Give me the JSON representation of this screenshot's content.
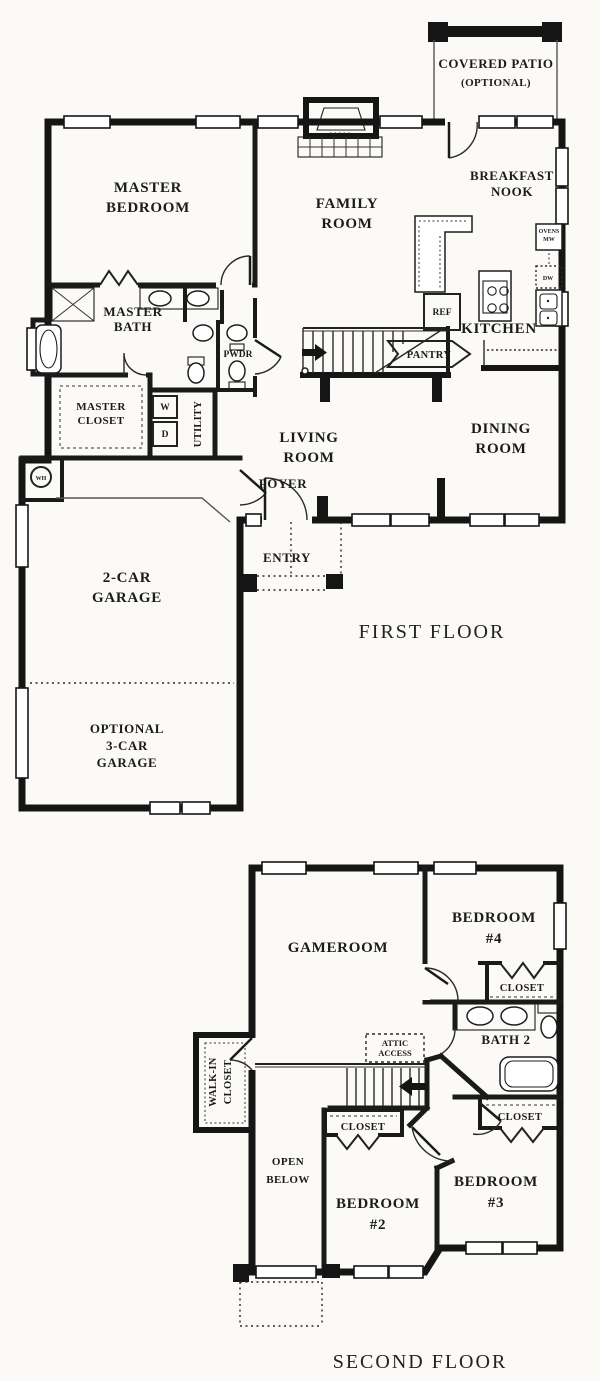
{
  "document": {
    "type": "two-story residential floor plan"
  },
  "colors": {
    "wall": "#151515",
    "paper": "#fbfaf6"
  },
  "ff": {
    "caption": "FIRST FLOOR",
    "covered_patio": [
      "COVERED PATIO",
      "(OPTIONAL)"
    ],
    "breakfast_nook": [
      "BREAKFAST",
      "NOOK"
    ],
    "master_bedroom": [
      "MASTER",
      "BEDROOM"
    ],
    "family_room": [
      "FAMILY",
      "ROOM"
    ],
    "kitchen": "KITCHEN",
    "ref": "REF",
    "ovens": "OVENS",
    "mw": "MW",
    "dw": "DW",
    "master_bath": [
      "MASTER",
      "BATH"
    ],
    "pwdr": "PWDR",
    "master_closet": [
      "MASTER",
      "CLOSET"
    ],
    "washer": "W",
    "dryer": "D",
    "utility": "UTILITY",
    "wh": "WH",
    "pantry": "PANTRY",
    "living_room": [
      "LIVING",
      "ROOM"
    ],
    "dining_room": [
      "DINING",
      "ROOM"
    ],
    "foyer": "FOYER",
    "entry": "ENTRY",
    "garage2": [
      "2-CAR",
      "GARAGE"
    ],
    "garage3": [
      "OPTIONAL",
      "3-CAR",
      "GARAGE"
    ]
  },
  "sf": {
    "caption": "SECOND FLOOR",
    "gameroom": "GAMEROOM",
    "bedroom4": [
      "BEDROOM",
      "#4"
    ],
    "closet_b4": "CLOSET",
    "bath2": "BATH 2",
    "closet_b3": "CLOSET",
    "attic": [
      "ATTIC",
      "ACCESS"
    ],
    "walkin": [
      "WALK-IN",
      "CLOSET"
    ],
    "open_below": [
      "OPEN",
      "BELOW"
    ],
    "closet_b2": "CLOSET",
    "bedroom2": [
      "BEDROOM",
      "#2"
    ],
    "bedroom3": [
      "BEDROOM",
      "#3"
    ]
  }
}
